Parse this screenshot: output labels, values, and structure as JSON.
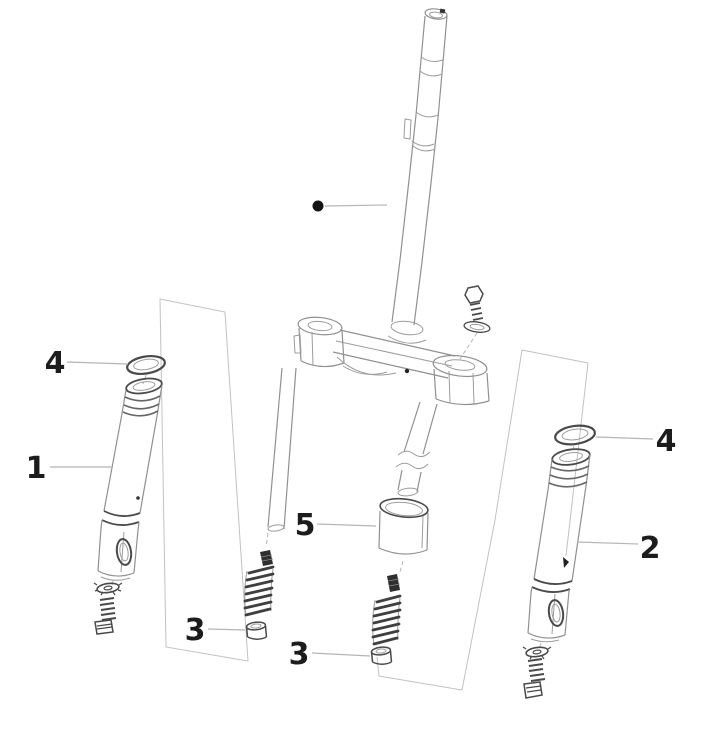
{
  "drawing": {
    "kind": "exploded-parts-line-drawing",
    "background": "#ffffff",
    "colors": {
      "line": "#909090",
      "dark_line": "#4a4a4a",
      "leader": "#b5b5b5",
      "group_box": "#c2c2c2",
      "label": "#1c1c1c",
      "dark_part": "#2e2e2e"
    },
    "marker": {
      "shape": "filled-circle",
      "color": "#141414"
    },
    "callouts": {
      "c1": {
        "label": "1"
      },
      "c2": {
        "label": "2"
      },
      "c3_left": {
        "label": "3"
      },
      "c3_right": {
        "label": "3"
      },
      "c4_left": {
        "label": "4"
      },
      "c4_right": {
        "label": "4"
      },
      "c5": {
        "label": "5"
      }
    }
  }
}
